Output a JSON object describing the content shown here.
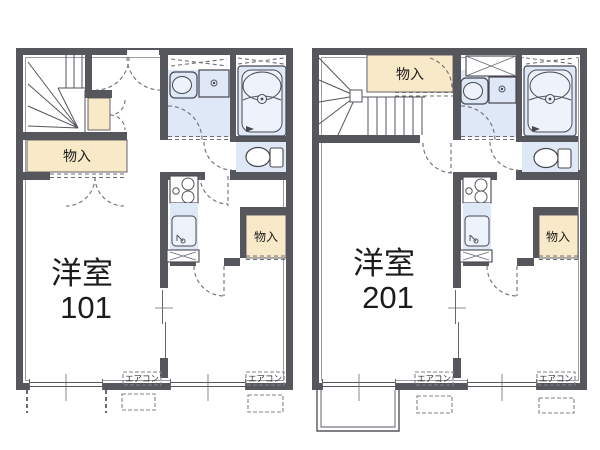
{
  "units": [
    {
      "name": "101",
      "room_label": "洋室",
      "room_number": "101",
      "hall_storage_label": "物入",
      "room_storage_label": "物入",
      "ac_label_left": "エアコン",
      "ac_label_right": "エアコン"
    },
    {
      "name": "201",
      "room_label": "洋室",
      "room_number": "201",
      "hall_storage_label": "物入",
      "room_storage_label": "物入",
      "ac_label_left": "エアコン",
      "ac_label_right": "エアコン"
    }
  ],
  "colors": {
    "wall": "#56565d",
    "storage_fill": "#f8e9c9",
    "fixture_fill": "#dfe8f6",
    "background": "#ffffff",
    "text": "#1b1b1b"
  }
}
